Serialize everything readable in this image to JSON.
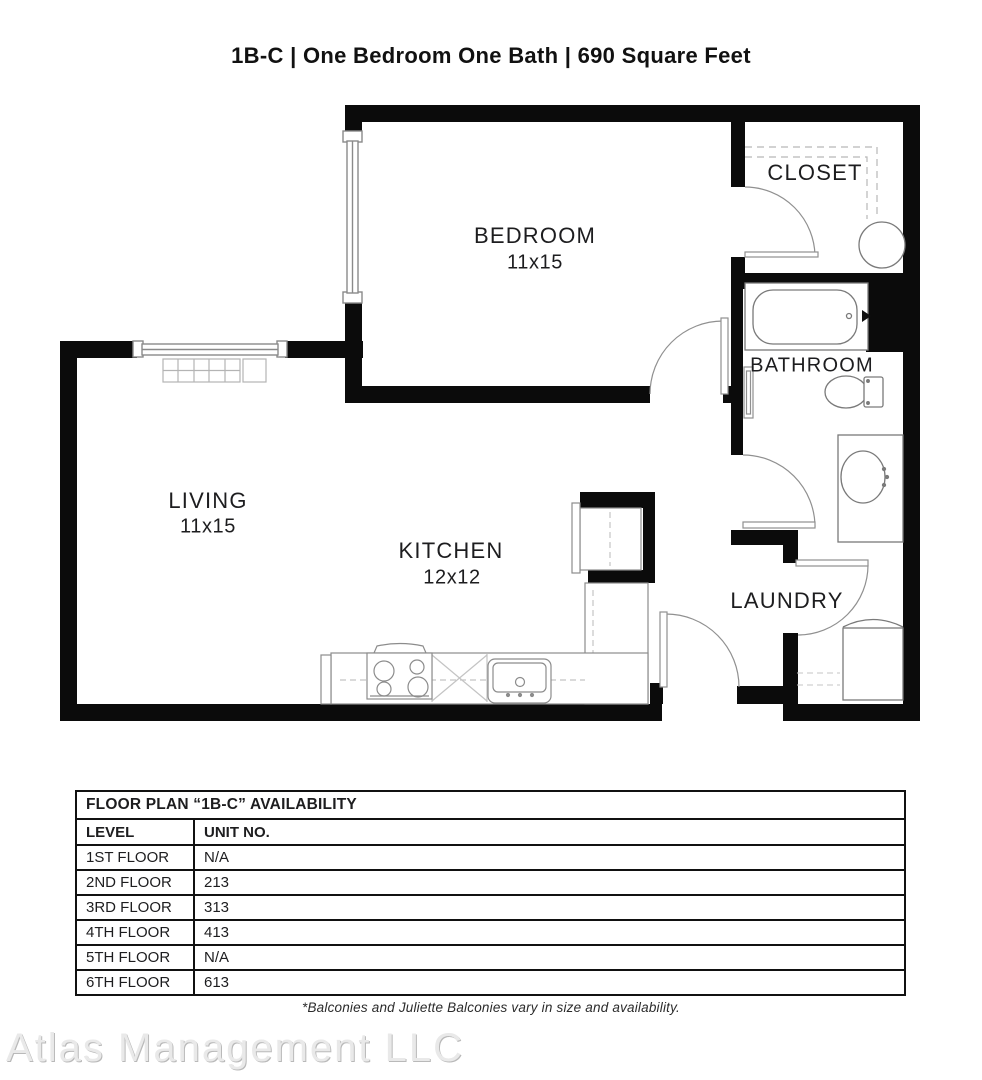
{
  "page_title": "1B-C  | One Bedroom One Bath |  690 Square Feet",
  "floor_plan": {
    "rooms": {
      "bedroom": {
        "name": "BEDROOM",
        "dimensions": "11x15"
      },
      "living": {
        "name": "LIVING",
        "dimensions": "11x15"
      },
      "kitchen": {
        "name": "KITCHEN",
        "dimensions": "12x12"
      },
      "closet": {
        "name": "CLOSET"
      },
      "bathroom": {
        "name": "BATHROOM"
      },
      "laundry": {
        "name": "LAUNDRY"
      }
    },
    "fixtures": [
      "bathtub",
      "toilet",
      "vanity-sink",
      "washer",
      "refrigerator",
      "stove",
      "dishwasher",
      "kitchen-sink",
      "baseboard-heater",
      "closet-shelves",
      "water-heater"
    ]
  },
  "availability_table": {
    "title": "FLOOR PLAN “1B-C” AVAILABILITY",
    "columns": {
      "level": "LEVEL",
      "unit": "UNIT NO."
    },
    "rows": [
      {
        "level": "1ST FLOOR",
        "unit": "N/A"
      },
      {
        "level": "2ND FLOOR",
        "unit": "213"
      },
      {
        "level": "3RD FLOOR",
        "unit": "313"
      },
      {
        "level": "4TH FLOOR",
        "unit": "413"
      },
      {
        "level": "5TH FLOOR",
        "unit": "N/A"
      },
      {
        "level": "6TH FLOOR",
        "unit": "613"
      }
    ]
  },
  "footnote": "*Balconies and Juliette Balconies vary in size and availability.",
  "watermark": "Atlas Management LLC",
  "colors": {
    "wall": "#0b0b0b",
    "fixture_line": "#7a7a7a",
    "door_line": "#909090",
    "dash_line": "#b8b8b8",
    "text": "#1d1d1f"
  }
}
